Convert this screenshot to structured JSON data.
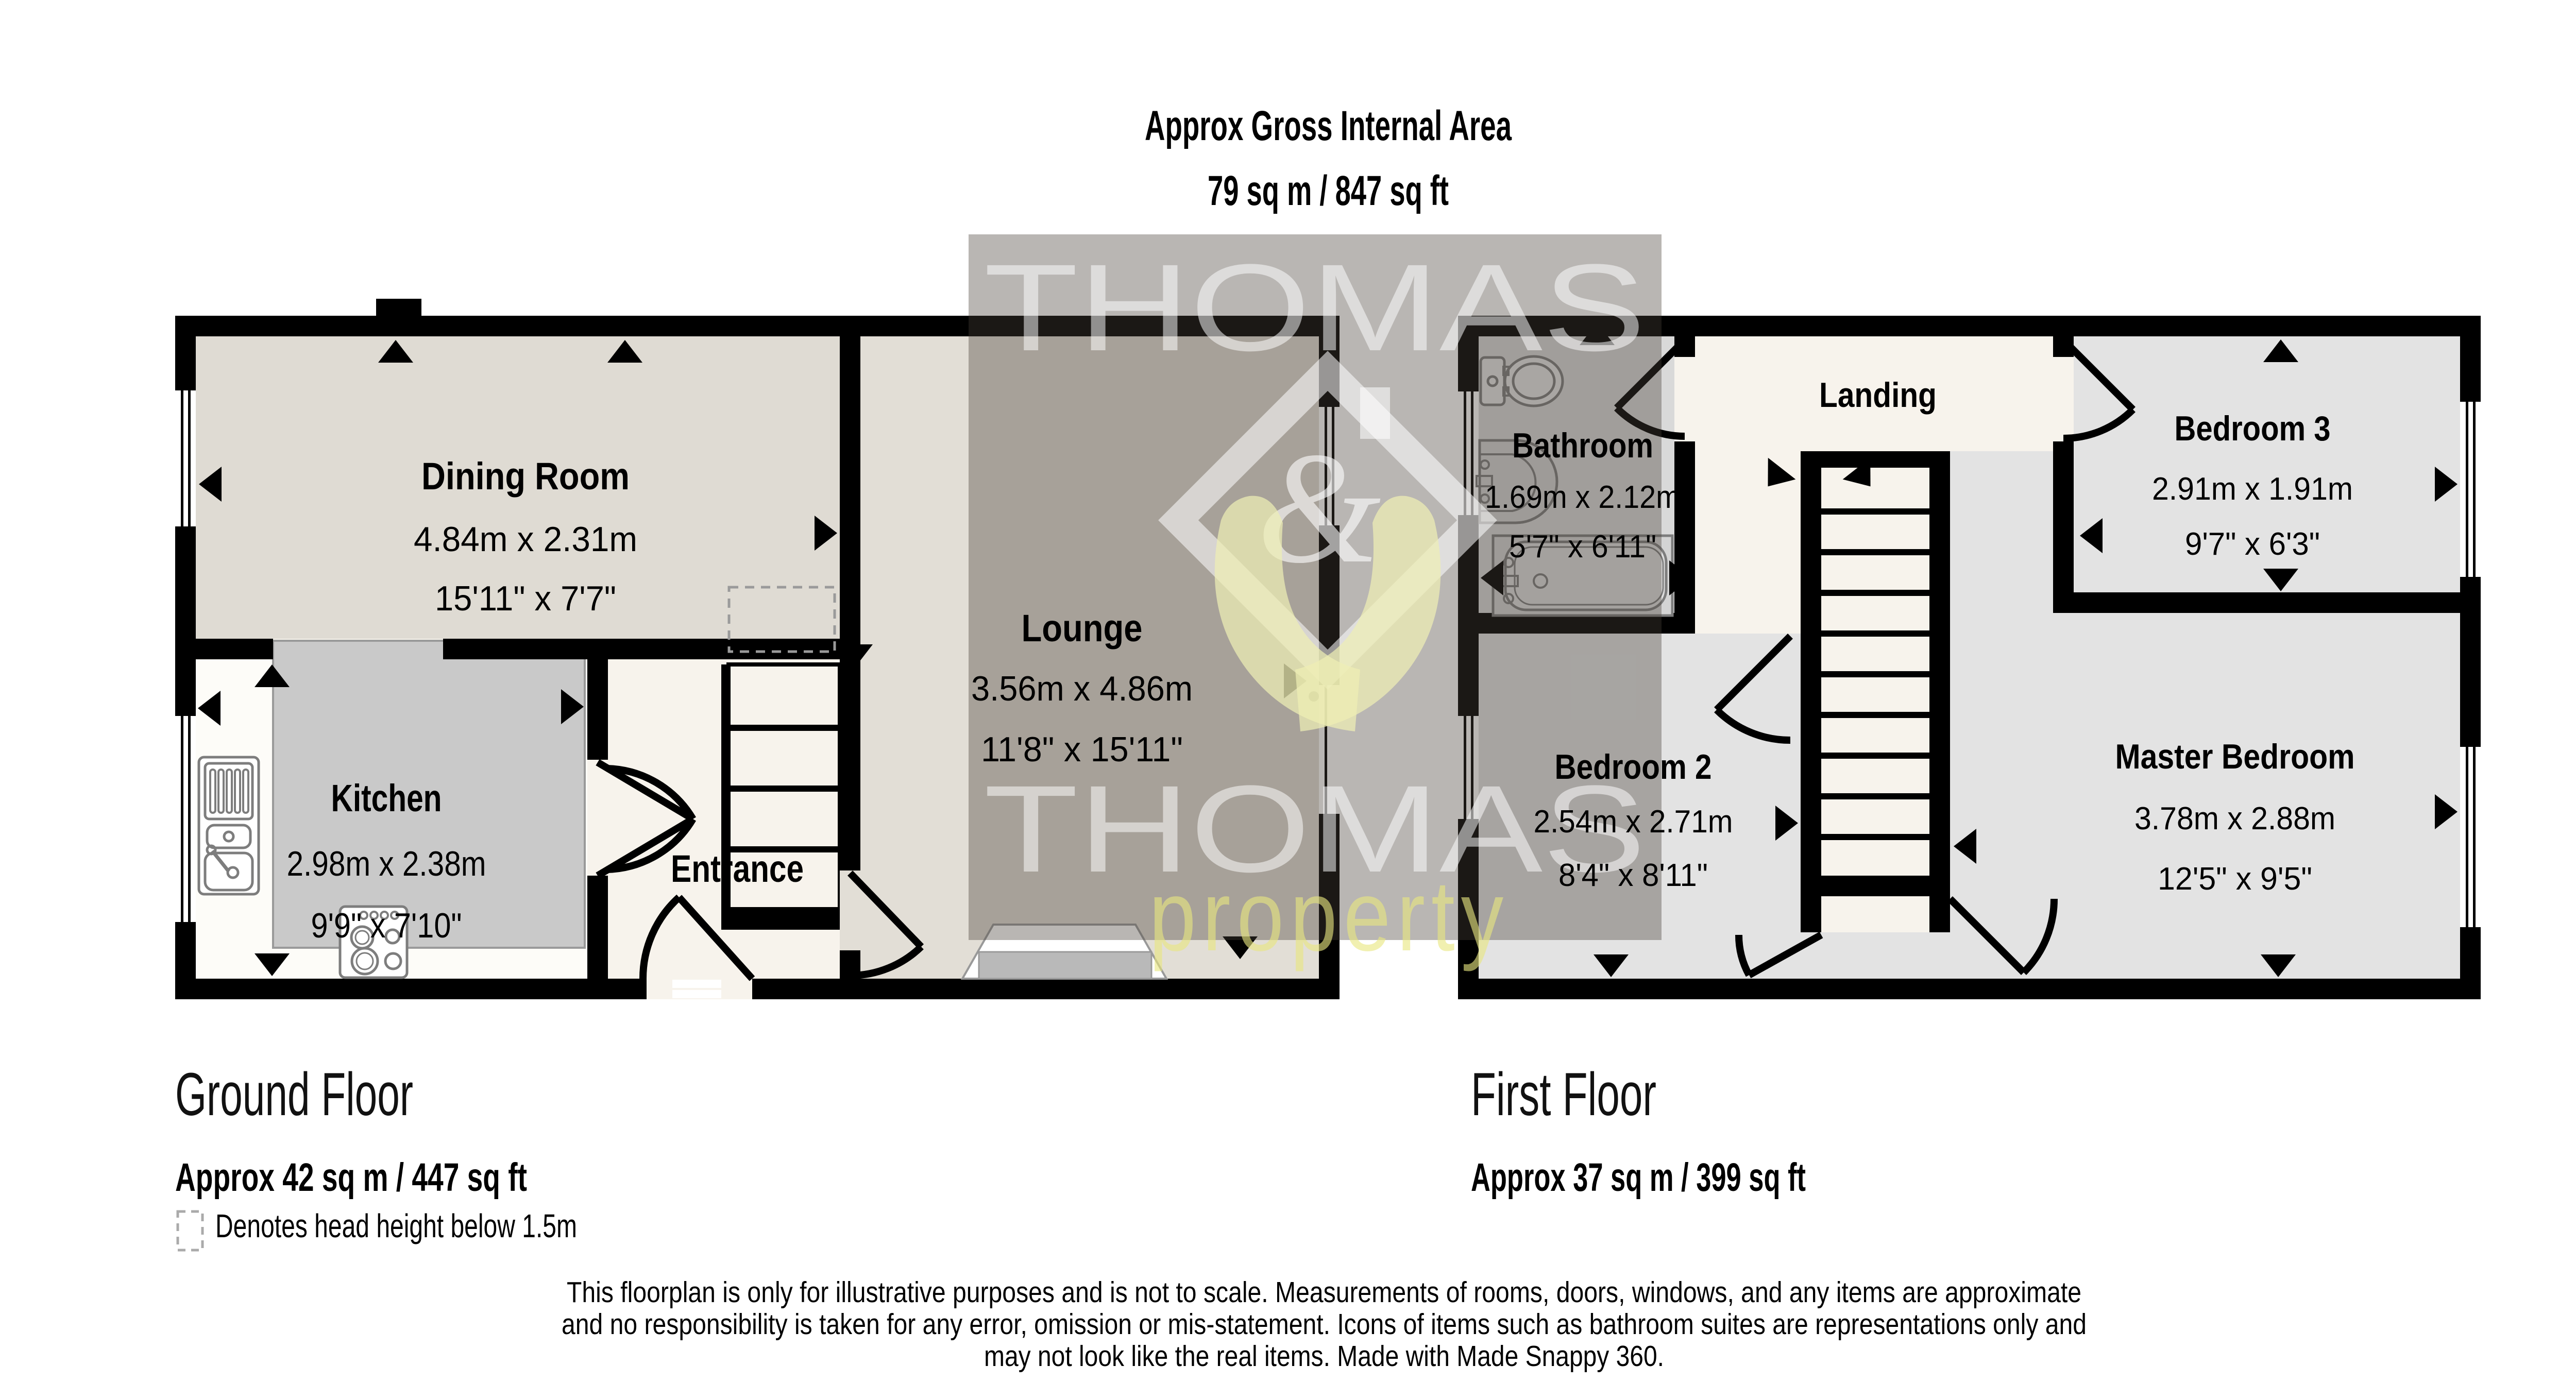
{
  "header": {
    "title": "Approx Gross Internal Area",
    "area": "79 sq m / 847 sq ft"
  },
  "watermark": {
    "word_top": "THOMAS",
    "ampersand": "&",
    "word_mid": "THOMAS",
    "word_bottom": "property"
  },
  "ground_floor": {
    "label": "Ground Floor",
    "area": "Approx 42 sq m / 447 sq ft",
    "rooms": {
      "dining": {
        "name": "Dining Room",
        "metric": "4.84m x 2.31m",
        "imperial": "15'11\" x 7'7\""
      },
      "kitchen": {
        "name": "Kitchen",
        "metric": "2.98m x 2.38m",
        "imperial": "9'9\" x 7'10\""
      },
      "entrance": {
        "name": "Entrance"
      },
      "lounge": {
        "name": "Lounge",
        "metric": "3.56m x 4.86m",
        "imperial": "11'8\" x 15'11\""
      }
    }
  },
  "first_floor": {
    "label": "First Floor",
    "area": "Approx 37 sq m / 399 sq ft",
    "rooms": {
      "bathroom": {
        "name": "Bathroom",
        "metric": "1.69m x 2.12m",
        "imperial": "5'7\" x 6'11\""
      },
      "landing": {
        "name": "Landing"
      },
      "bedroom3": {
        "name": "Bedroom 3",
        "metric": "2.91m x 1.91m",
        "imperial": "9'7\" x 6'3\""
      },
      "bedroom2": {
        "name": "Bedroom 2",
        "metric": "2.54m x 2.71m",
        "imperial": "8'4\" x 8'11\""
      },
      "master": {
        "name": "Master Bedroom",
        "metric": "3.78m x 2.88m",
        "imperial": "12'5\" x 9'5\""
      }
    }
  },
  "legend": {
    "text": "Denotes head height below 1.5m"
  },
  "disclaimer": {
    "line1": "This floorplan is only for illustrative purposes and is not to scale. Measurements of rooms, doors, windows, and any items are approximate",
    "line2": "and no responsibility is taken for any error, omission or mis-statement. Icons of items such as bathroom suites are representations only and",
    "line3": "may not look like the real items. Made with Made Snappy 360."
  },
  "colors": {
    "wall": "#000000",
    "dining_floor": "#dfdbd3",
    "kitchen_floor": "#fdfcf8",
    "kitchen_zone": "#c9c9c9",
    "entrance_floor": "#f7f3ec",
    "lounge_floor": "#e2ded6",
    "bedroom_floor": "#e3e3e3",
    "bathroom_floor": "#d9d9d9",
    "landing_floor": "#f7f3ec",
    "watermark_overlay": "rgba(70,64,56,0.38)",
    "accent_hands": "rgba(238,238,180,0.72)"
  }
}
